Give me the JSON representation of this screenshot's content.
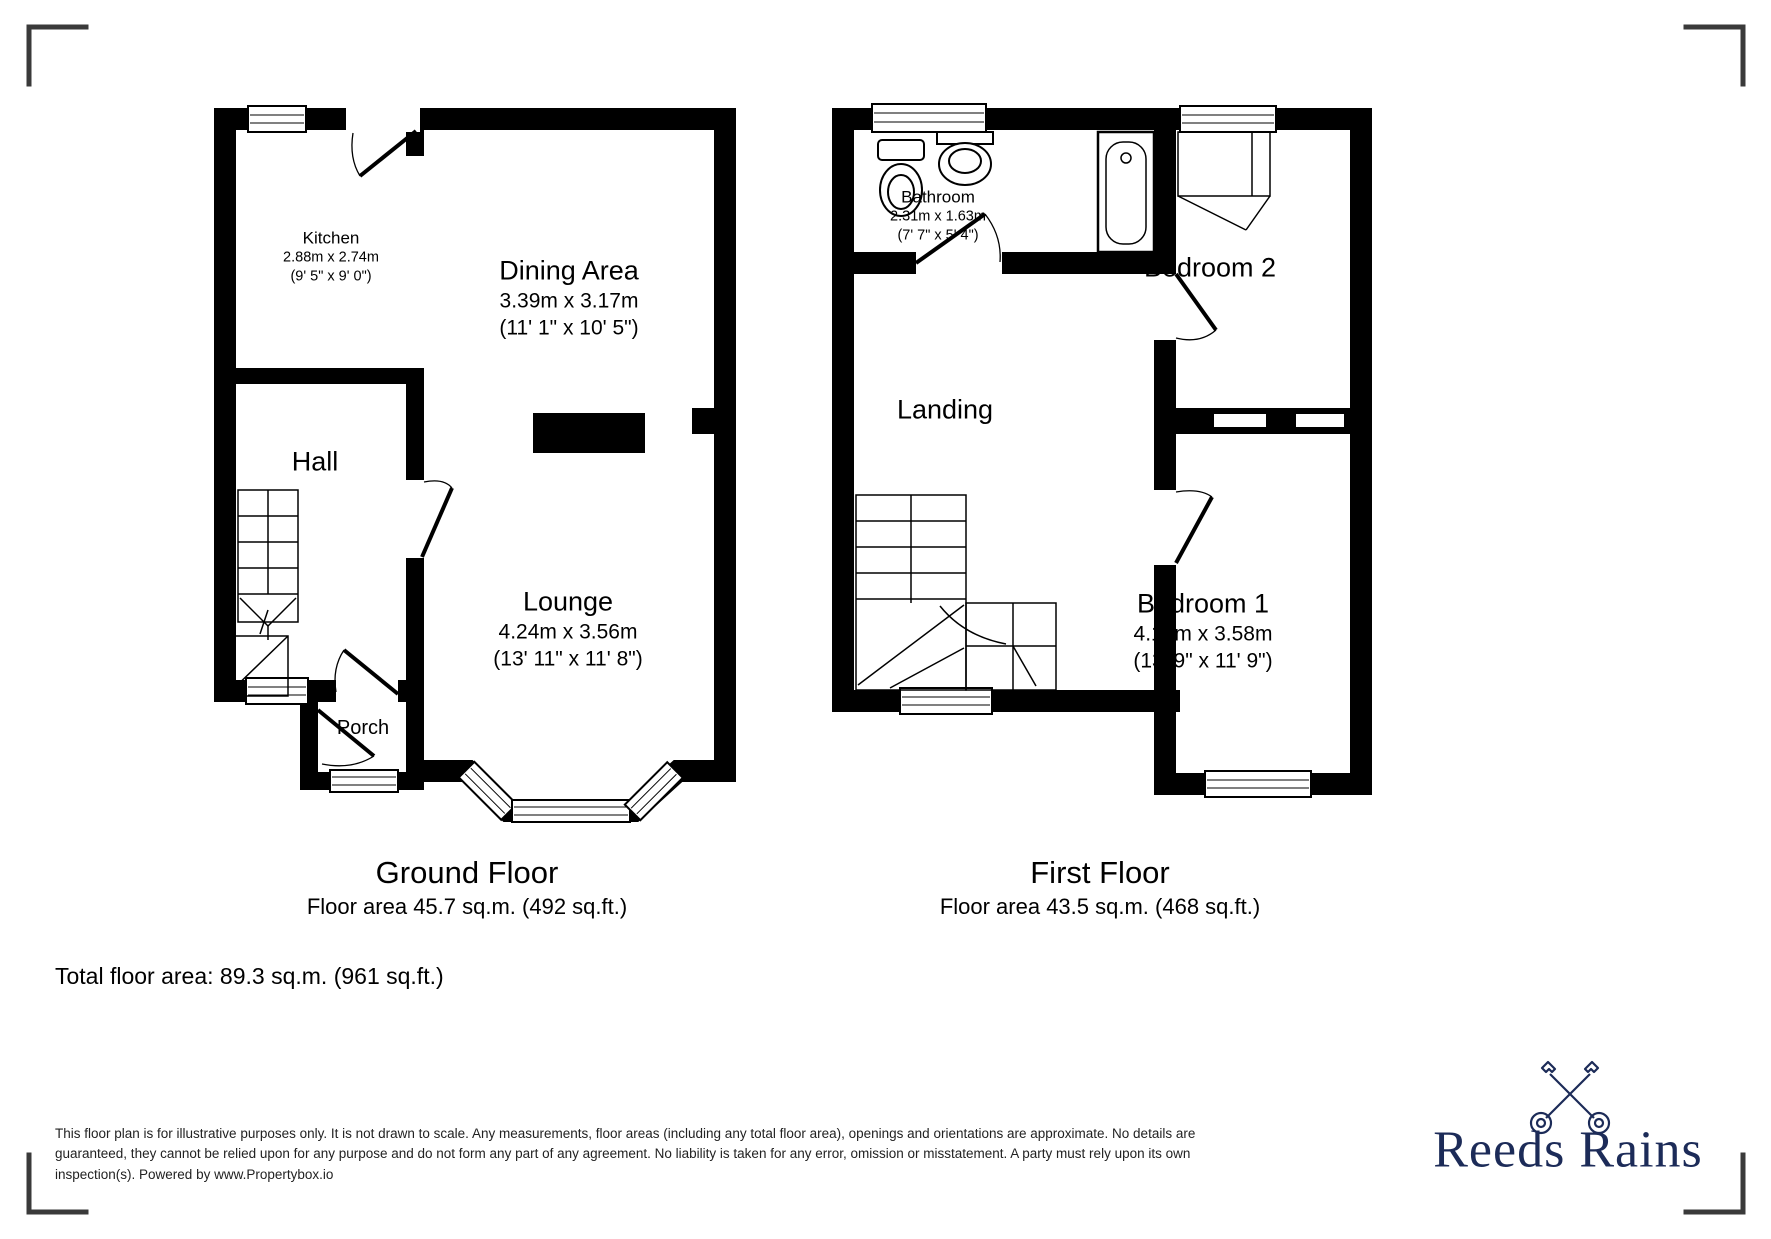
{
  "ground_floor": {
    "title": "Ground Floor",
    "area": "Floor area 45.7 sq.m. (492 sq.ft.)",
    "rooms": {
      "kitchen": {
        "name": "Kitchen",
        "dims_m": "2.88m x 2.74m",
        "dims_ft": "(9' 5\" x 9' 0\")"
      },
      "dining": {
        "name": "Dining Area",
        "dims_m": "3.39m x 3.17m",
        "dims_ft": "(11' 1\" x 10' 5\")"
      },
      "hall": {
        "name": "Hall"
      },
      "lounge": {
        "name": "Lounge",
        "dims_m": "4.24m x 3.56m",
        "dims_ft": "(13' 11\" x 11' 8\")"
      },
      "porch": {
        "name": "Porch"
      }
    }
  },
  "first_floor": {
    "title": "First Floor",
    "area": "Floor area 43.5 sq.m. (468 sq.ft.)",
    "rooms": {
      "bathroom": {
        "name": "Bathroom",
        "dims_m": "2.31m x 1.63m",
        "dims_ft": "(7' 7\" x 5' 4\")"
      },
      "bedroom2": {
        "name": "Bedroom 2"
      },
      "landing": {
        "name": "Landing"
      },
      "bedroom1": {
        "name": "Bedroom 1",
        "dims_m": "4.19m x 3.58m",
        "dims_ft": "(13' 9\" x 11' 9\")"
      }
    }
  },
  "summary": {
    "total_area": "Total floor area: 89.3 sq.m. (961 sq.ft.)"
  },
  "disclaimer": {
    "text": "This floor plan is for illustrative purposes only. It is not drawn to scale. Any measurements, floor areas (including any total floor area), openings and orientations are approximate. No details are guaranteed, they cannot be relied upon for any purpose and do not form any part of any agreement. No liability is taken for any error, omission or misstatement. A party must rely upon its own inspection(s). Powered by www.Propertybox.io"
  },
  "branding": {
    "name": "Reeds Rains",
    "icon": "crossed-keys-icon",
    "color": "#1c2b58"
  },
  "colors": {
    "walls": "#000000",
    "corner_marks": "#3a3a3a"
  }
}
